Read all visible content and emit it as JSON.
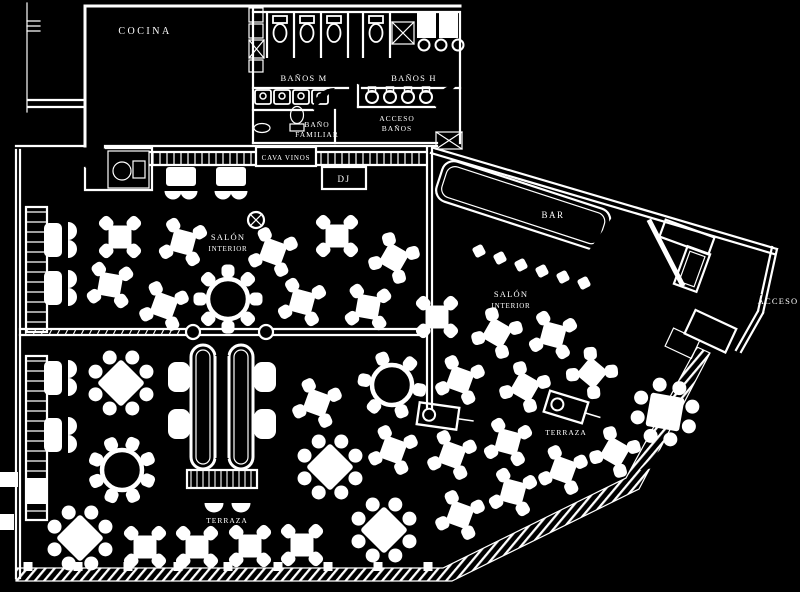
{
  "colors": {
    "background": "#000000",
    "line": "#ffffff"
  },
  "labels": {
    "cocina": "COCINA",
    "banos_m": "BAÑOS M",
    "banos_h": "BAÑOS H",
    "bano_fam1": "BAÑO",
    "bano_fam2": "FAMILIAR",
    "acceso_banos1": "ACCESO",
    "acceso_banos2": "BAÑOS",
    "cava_vinos": "CAVA VINOS",
    "dj": "DJ",
    "salon1a": "SALÓN",
    "salon1b": "INTERIOR",
    "salon2a": "SALÓN",
    "salon2b": "INTERIOR",
    "bar": "BAR",
    "acceso": "ACCESO",
    "terraza1": "TERRAZA",
    "terraza2": "TERRAZA"
  },
  "furniture": {
    "tables_four_seat": [
      [
        120,
        237,
        0
      ],
      [
        183,
        242,
        15
      ],
      [
        273,
        252,
        20
      ],
      [
        337,
        236,
        0
      ],
      [
        394,
        258,
        30
      ],
      [
        110,
        285,
        10
      ],
      [
        164,
        306,
        20
      ],
      [
        302,
        302,
        15
      ],
      [
        368,
        307,
        10
      ],
      [
        437,
        317,
        0
      ],
      [
        497,
        333,
        30
      ],
      [
        553,
        335,
        15
      ],
      [
        592,
        373,
        40
      ],
      [
        525,
        387,
        30
      ],
      [
        460,
        380,
        20
      ],
      [
        317,
        403,
        20
      ],
      [
        393,
        450,
        20
      ],
      [
        615,
        452,
        30
      ],
      [
        508,
        442,
        15
      ],
      [
        452,
        455,
        20
      ],
      [
        563,
        470,
        20
      ],
      [
        513,
        492,
        15
      ],
      [
        460,
        515,
        20
      ],
      [
        145,
        547,
        0
      ],
      [
        197,
        547,
        0
      ],
      [
        250,
        546,
        0
      ],
      [
        302,
        545,
        0
      ]
    ],
    "tables_eight_seat_square": [
      [
        121,
        383,
        45
      ],
      [
        80,
        538,
        45
      ],
      [
        330,
        467,
        45
      ],
      [
        384,
        530,
        45
      ],
      [
        665,
        412,
        10
      ]
    ],
    "tables_round": [
      [
        228,
        299,
        8,
        0
      ],
      [
        122,
        470,
        8,
        22
      ],
      [
        392,
        385,
        6,
        10
      ]
    ],
    "wall_tables_y": [
      240,
      288,
      378,
      435
    ],
    "counter_tables_x": [
      181,
      231
    ],
    "bar_stools": [
      [
        479,
        251
      ],
      [
        500,
        258
      ],
      [
        521,
        265
      ],
      [
        542,
        271
      ],
      [
        563,
        277
      ],
      [
        584,
        283
      ]
    ],
    "service_stations": [
      [
        438,
        416,
        8
      ],
      [
        566,
        407,
        17
      ]
    ],
    "fence_posts_x": [
      28,
      78,
      128,
      178,
      228,
      278,
      328,
      378,
      428
    ],
    "toilets_x": [
      280,
      307,
      334,
      376
    ],
    "stall_walls_x": [
      267,
      294,
      321,
      348,
      363,
      390
    ],
    "sinks_women_x": [
      263,
      282,
      301,
      320
    ],
    "urinals_x": [
      372,
      390,
      408,
      426
    ],
    "sinks_men_x": [
      424,
      441,
      458
    ]
  }
}
